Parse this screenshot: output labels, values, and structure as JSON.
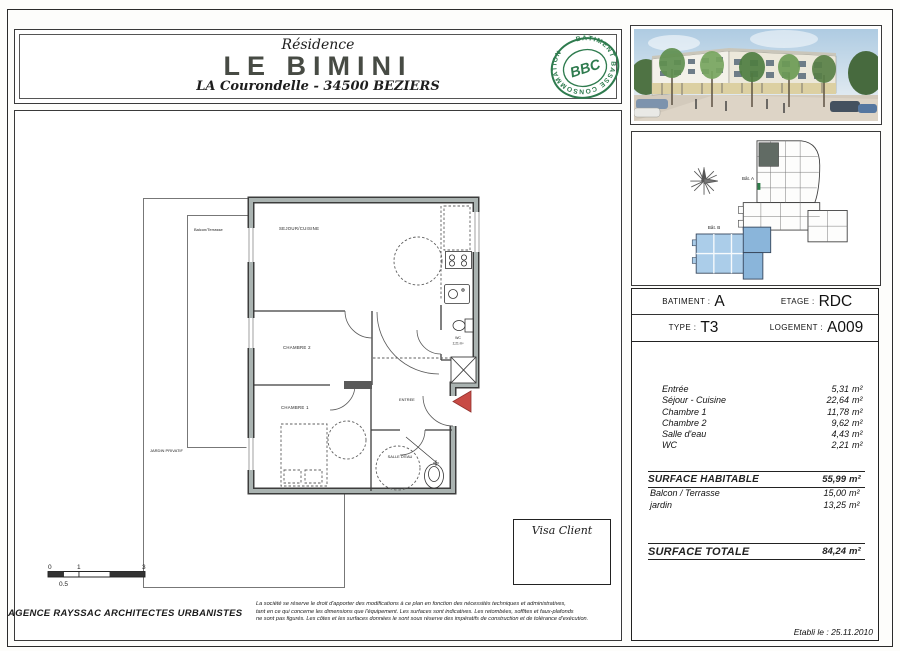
{
  "header": {
    "residence": "Résidence",
    "title": "LE BIMINI",
    "subtitle": "LA Courondelle - 34500 BEZIERS",
    "bbc": {
      "ring_text": "BÂTIMENT  BASSE  CONSOMMATION ·",
      "center": "BBC",
      "color": "#2e7b4e"
    }
  },
  "site_plan": {
    "bat_a_label": "Bât. A",
    "bat_b_label": "Bât. B",
    "highlight_blue": "#abcde9",
    "highlight_dark": "#616b64"
  },
  "plan_labels": {
    "sejour": "SEJOUR/CUISINE",
    "chambre2": "CHAMBRE 2",
    "chambre1": "CHAMBRE 1",
    "entree": "ENTREE",
    "salle_deau": "SALLE D'EAU",
    "wc_line1": "WC",
    "wc_line2": "2,21 m²",
    "balcon": "Balcon/Terrasse",
    "jardin": "JARDIN PRIVATIF"
  },
  "info_table": {
    "batiment_label": "BATIMENT :",
    "batiment_value": "A",
    "etage_label": "ETAGE :",
    "etage_value": "RDC",
    "type_label": "TYPE :",
    "type_value": "T3",
    "logement_label": "LOGEMENT :",
    "logement_value": "A009",
    "rooms": [
      {
        "name": "Entrée",
        "area": "5,31",
        "unit": "m²"
      },
      {
        "name": "Séjour - Cuisine",
        "area": "22,64",
        "unit": "m²"
      },
      {
        "name": "Chambre 1",
        "area": "11,78",
        "unit": "m²"
      },
      {
        "name": "Chambre 2",
        "area": "9,62",
        "unit": "m²"
      },
      {
        "name": "Salle d'eau",
        "area": "4,43",
        "unit": "m²"
      },
      {
        "name": "WC",
        "area": "2,21",
        "unit": "m²"
      }
    ],
    "surface_habitable_label": "SURFACE HABITABLE",
    "surface_habitable_value": "55,99",
    "surface_habitable_unit": "m²",
    "extras": [
      {
        "name": "Balcon / Terrasse",
        "value": "15,00",
        "unit": "m²"
      },
      {
        "name": "jardin",
        "value": "13,25",
        "unit": "m²"
      }
    ],
    "surface_totale_label": "SURFACE TOTALE",
    "surface_totale_value": "84,24",
    "surface_totale_unit": "m²",
    "etabli": "Etabli le : 25.11.2010"
  },
  "footer": {
    "agency": "AGENCE RAYSSAC ARCHITECTES URBANISTES",
    "visa_label": "Visa Client",
    "disclaimer": [
      "La société se réserve le droit d'apporter des modifications à ce plan en fonction des nécessités techniques et administratives,",
      "tant en ce qui concerne les dimensions que l'équipement. Les surfaces sont indicatives. Les retombées, soffites et faux-plafonds",
      "ne sont pas figurés. Les côtes et les surfaces données le sont sous réserve des impératifs de construction et de tolérance d'exécution."
    ],
    "scale": {
      "tick0": "0",
      "tick1": "1",
      "tick3": "3",
      "tick05": "0.5"
    },
    "entry_arrow_color": "#c84b45"
  }
}
